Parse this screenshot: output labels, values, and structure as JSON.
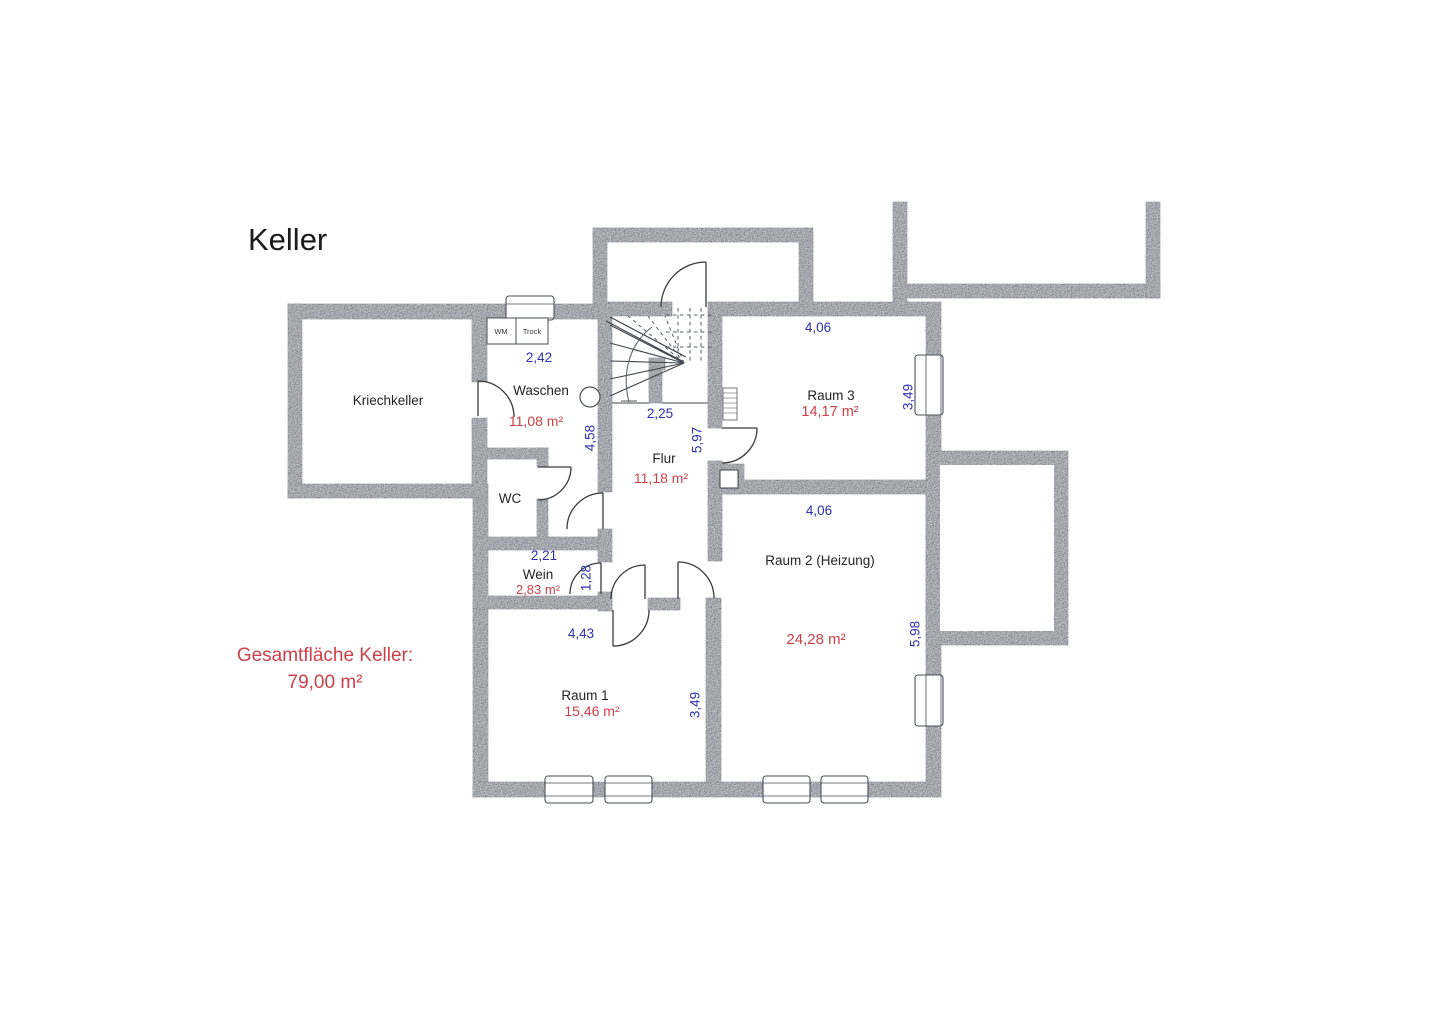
{
  "title": "Keller",
  "total": {
    "label": "Gesamtfläche Keller:",
    "value": "79,00 m²"
  },
  "rooms": {
    "kriechkeller": {
      "name": "Kriechkeller"
    },
    "waschen": {
      "name": "Waschen",
      "area": "11,08 m²",
      "dim_width": "2,42",
      "dim_height": "4,58"
    },
    "wc": {
      "name": "WC"
    },
    "wein": {
      "name": "Wein",
      "area": "2,83 m²",
      "dim_width": "2,21",
      "dim_height": "1,28"
    },
    "flur": {
      "name": "Flur",
      "area": "11,18 m²",
      "dim_width": "2,25",
      "dim_height": "5,97"
    },
    "raum1": {
      "name": "Raum 1",
      "area": "15,46 m²",
      "dim_width": "4,43",
      "dim_height": "3,49"
    },
    "raum2": {
      "name": "Raum 2 (Heizung)",
      "area": "24,28 m²",
      "dim_width": "4,06",
      "dim_height": "5,98"
    },
    "raum3": {
      "name": "Raum 3",
      "area": "14,17 m²",
      "dim_width": "4,06",
      "dim_height": "3,49"
    }
  },
  "appliances": {
    "wm": "WM",
    "trock": "Trock"
  },
  "colors": {
    "wall": "#6e747d",
    "dimension_text": "#2f2fae",
    "area_text": "#cc4149",
    "room_text": "#242424"
  }
}
